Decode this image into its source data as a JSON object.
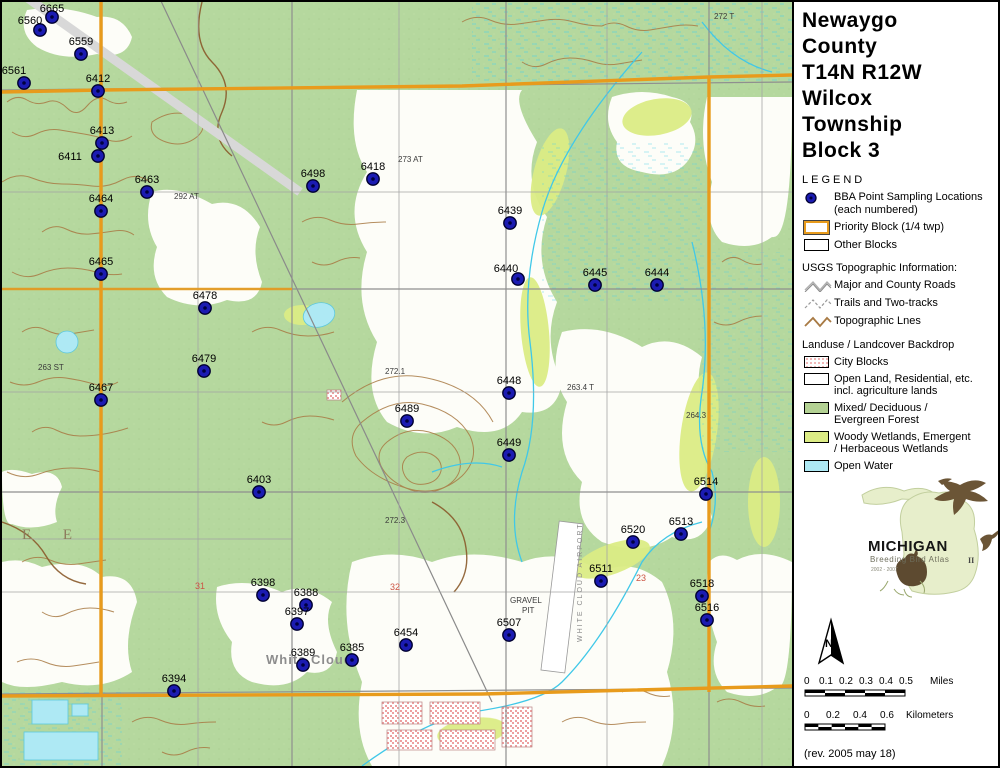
{
  "sidebar": {
    "title_lines": [
      "Newaygo",
      "County",
      "T14N R12W",
      "Wilcox",
      "Township",
      "Block 3"
    ],
    "legend_heading": "LEGEND",
    "legend": {
      "bba_line1": "BBA Point Sampling Locations",
      "bba_line2": "(each numbered)",
      "priority": "Priority Block (1/4 twp)",
      "other": "Other Blocks",
      "usgs_heading": "USGS Topographic Information:",
      "roads": "Major and County Roads",
      "trails": "Trails and Two-tracks",
      "topo": "Topographic Lnes",
      "landuse_heading": "Landuse / Landcover Backdrop",
      "city": "City Blocks",
      "open1": "Open Land, Residential, etc.",
      "open2": "incl. agriculture lands",
      "forest1": "Mixed/ Deciduous /",
      "forest2": "Evergreen Forest",
      "wetland1": "Woody Wetlands, Emergent",
      "wetland2": "/ Herbaceous Wetlands",
      "water": "Open Water"
    },
    "logo": {
      "name": "MICHIGAN",
      "subtitle": "Breeding Bird Atlas",
      "years": "2002 - 2007",
      "numeral": "II"
    },
    "north_label": "N",
    "scale_miles": {
      "ticks": [
        "0",
        "0.1",
        "0.2",
        "0.3",
        "0.4",
        "0.5"
      ],
      "unit": "Miles"
    },
    "scale_km": {
      "ticks": [
        "0",
        "0.2",
        "0.4",
        "0.6"
      ],
      "unit": "Kilometers"
    },
    "revision": "(rev. 2005 may 18)"
  },
  "map": {
    "colors": {
      "forest": "#b5d89e",
      "wetland": "#dcec85",
      "water": "#aee9f4",
      "priority_block": "#e89b1c",
      "contour": "#a87a44",
      "point_fill": "#1b1bb2"
    },
    "points": [
      {
        "id": "6665",
        "x": 50,
        "y": 15,
        "ly": 10
      },
      {
        "id": "6560",
        "x": 38,
        "y": 28,
        "lx": 28,
        "ly": 22
      },
      {
        "id": "6559",
        "x": 79,
        "y": 52
      },
      {
        "id": "6561",
        "x": 22,
        "y": 81,
        "lx": 12
      },
      {
        "id": "6412",
        "x": 96,
        "y": 89
      },
      {
        "id": "6413",
        "x": 100,
        "y": 141
      },
      {
        "id": "6411",
        "x": 96,
        "y": 154,
        "lx": 68,
        "ly": 158
      },
      {
        "id": "6463",
        "x": 145,
        "y": 190
      },
      {
        "id": "6464",
        "x": 99,
        "y": 209
      },
      {
        "id": "6465",
        "x": 99,
        "y": 272
      },
      {
        "id": "6478",
        "x": 203,
        "y": 306
      },
      {
        "id": "6479",
        "x": 202,
        "y": 369
      },
      {
        "id": "6467",
        "x": 99,
        "y": 398
      },
      {
        "id": "6498",
        "x": 311,
        "y": 184
      },
      {
        "id": "6418",
        "x": 371,
        "y": 177
      },
      {
        "id": "6439",
        "x": 508,
        "y": 221
      },
      {
        "id": "6440",
        "x": 516,
        "y": 277,
        "lx": 504,
        "ly": 270
      },
      {
        "id": "6445",
        "x": 593,
        "y": 283
      },
      {
        "id": "6444",
        "x": 655,
        "y": 283
      },
      {
        "id": "6448",
        "x": 507,
        "y": 391
      },
      {
        "id": "6489",
        "x": 405,
        "y": 419
      },
      {
        "id": "6449",
        "x": 507,
        "y": 453
      },
      {
        "id": "6403",
        "x": 257,
        "y": 490
      },
      {
        "id": "6514",
        "x": 704,
        "y": 492
      },
      {
        "id": "6513",
        "x": 679,
        "y": 532
      },
      {
        "id": "6520",
        "x": 631,
        "y": 540
      },
      {
        "id": "6511",
        "x": 599,
        "y": 579
      },
      {
        "id": "6518",
        "x": 700,
        "y": 594
      },
      {
        "id": "6516",
        "x": 705,
        "y": 618
      },
      {
        "id": "6398",
        "x": 261,
        "y": 593
      },
      {
        "id": "6388",
        "x": 304,
        "y": 603
      },
      {
        "id": "6397",
        "x": 295,
        "y": 622
      },
      {
        "id": "6507",
        "x": 507,
        "y": 633
      },
      {
        "id": "6454",
        "x": 404,
        "y": 643
      },
      {
        "id": "6385",
        "x": 350,
        "y": 658
      },
      {
        "id": "6389",
        "x": 301,
        "y": 663
      },
      {
        "id": "6394",
        "x": 172,
        "y": 689
      }
    ],
    "annotations": [
      {
        "text": "White Cloud",
        "x": 264,
        "y": 662,
        "cls": "town"
      },
      {
        "text": "E E",
        "x": 20,
        "y": 537,
        "cls": "twp"
      },
      {
        "text": "GRAVEL",
        "x": 508,
        "y": 601,
        "cls": "topo"
      },
      {
        "text": "PIT",
        "x": 520,
        "y": 611,
        "cls": "topo"
      },
      {
        "text": "WHITE CLOUD AIRPORT",
        "x": 580,
        "y": 640,
        "cls": "airport",
        "rot": -90
      },
      {
        "text": "31",
        "x": 193,
        "y": 587,
        "cls": "sec"
      },
      {
        "text": "32",
        "x": 388,
        "y": 588,
        "cls": "sec"
      },
      {
        "text": "23",
        "x": 634,
        "y": 579,
        "cls": "sec"
      },
      {
        "text": "292 AT",
        "x": 172,
        "y": 197,
        "cls": "topo"
      },
      {
        "text": "273 AT",
        "x": 396,
        "y": 160,
        "cls": "topo"
      },
      {
        "text": "272 T",
        "x": 712,
        "y": 17,
        "cls": "topo"
      },
      {
        "text": "272.1",
        "x": 383,
        "y": 372,
        "cls": "topo"
      },
      {
        "text": "272.3",
        "x": 383,
        "y": 521,
        "cls": "topo"
      },
      {
        "text": "263.4 T",
        "x": 565,
        "y": 388,
        "cls": "topo"
      },
      {
        "text": "264.3",
        "x": 684,
        "y": 416,
        "cls": "topo"
      },
      {
        "text": "263 ST",
        "x": 36,
        "y": 368,
        "cls": "topo"
      }
    ]
  }
}
